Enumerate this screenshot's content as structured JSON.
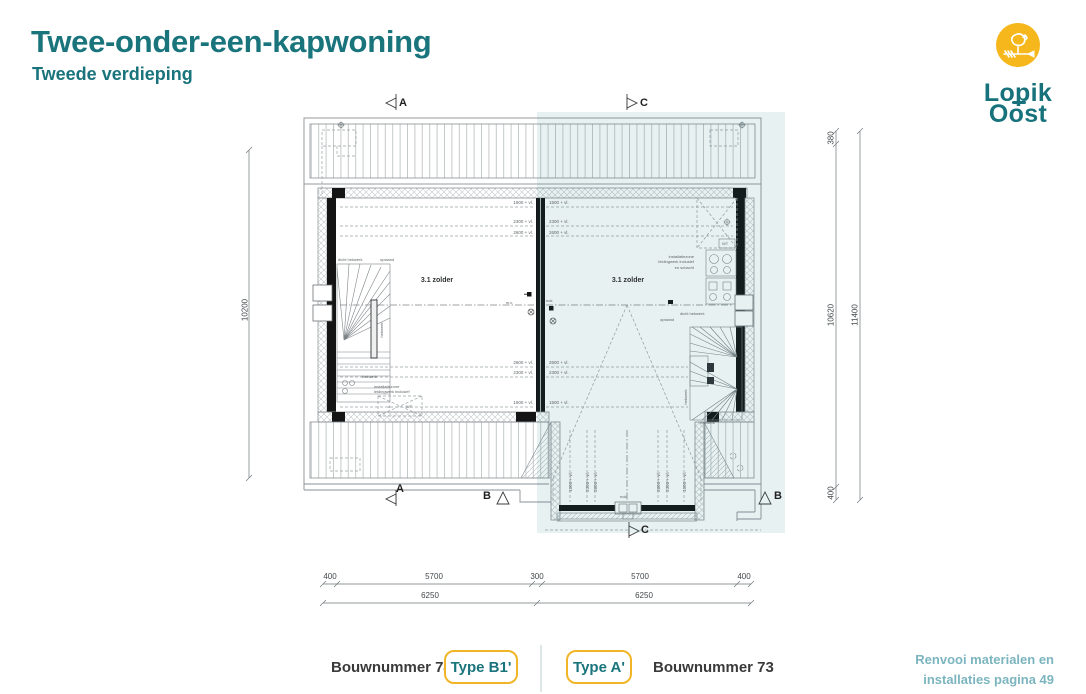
{
  "header": {
    "title": "Twee-onder-een-kapwoning",
    "subtitle": "Tweede verdieping"
  },
  "logo": {
    "icon": "rooster-weathervane-icon",
    "name_line1": "Lopik",
    "name_line2": "Oost",
    "circle_color": "#f6b71d",
    "text_color": "#17727b"
  },
  "plan": {
    "room_left": "3.1 zolder",
    "room_right": "3.1 zolder",
    "markers": {
      "a": "A",
      "b": "B",
      "c": "C"
    },
    "levels": {
      "v1500": "1500 + vl.",
      "v2300": "2300 + vl.",
      "v2600": "2600 + vl."
    },
    "nok": "nok",
    "mv": "m.v.",
    "annotations": {
      "dicht_hekwerk": "dicht hekwerk",
      "opstand": "opstand",
      "hekwerk": "hekwerk",
      "inst1": "installatiezone",
      "inst2": "leidingwerk inclusief",
      "inst3": "en schacht",
      "wt": "WT",
      "d": "d"
    },
    "dimensions": {
      "left_total": "10200",
      "right_seg_top": "380",
      "right_seg_mid": "10620",
      "right_seg_bottom": "400",
      "right_total": "11400",
      "bottom_row1": [
        "400",
        "5700",
        "300",
        "5700",
        "400"
      ],
      "bottom_row2": [
        "6250",
        "6250"
      ]
    },
    "highlight_color": "rgba(31,117,124,0.10)"
  },
  "footer": {
    "bouwnummer_left": "Bouwnummer 74",
    "type_left": "Type B1'",
    "type_right": "Type A'",
    "bouwnummer_right": "Bouwnummer 73",
    "note_line1": "Renvooi materialen en",
    "note_line2": "installaties pagina 49"
  }
}
